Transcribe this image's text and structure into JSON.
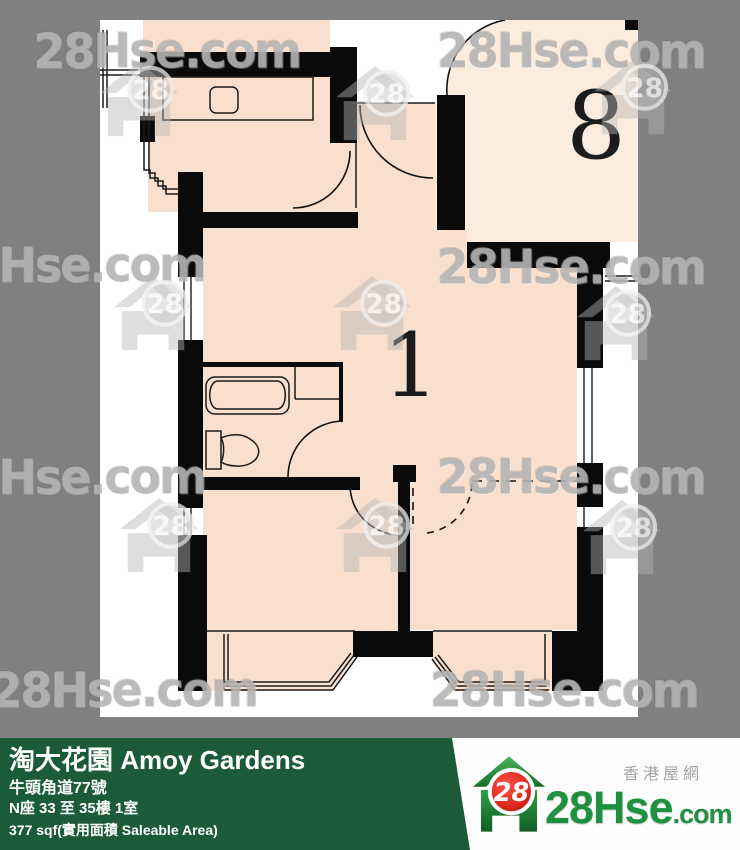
{
  "colors": {
    "background_gray": "#808080",
    "plan_background": "#ffffff",
    "room_fill": "#f9dfcd",
    "unit8_fill": "#fcecdd",
    "wall_black": "#0a0a0a",
    "footer_green": "#1b5b38",
    "logo_green": "#1e9140",
    "logo_red": "#e02b1c"
  },
  "plan": {
    "unit1_label": "1",
    "unit8_label": "8"
  },
  "watermark": {
    "text": "28Hse.com",
    "badge": "28"
  },
  "footer": {
    "title": "淘大花園 Amoy Gardens",
    "address": "牛頭角道77號",
    "block_floor_flat": "N座 33 至 35樓 1室",
    "area": "377 sqf(實用面積 Saleable Area)"
  },
  "logo": {
    "site_name": "香港屋網",
    "brand_main": "28Hse",
    "brand_suffix": ".com",
    "badge": "28"
  }
}
